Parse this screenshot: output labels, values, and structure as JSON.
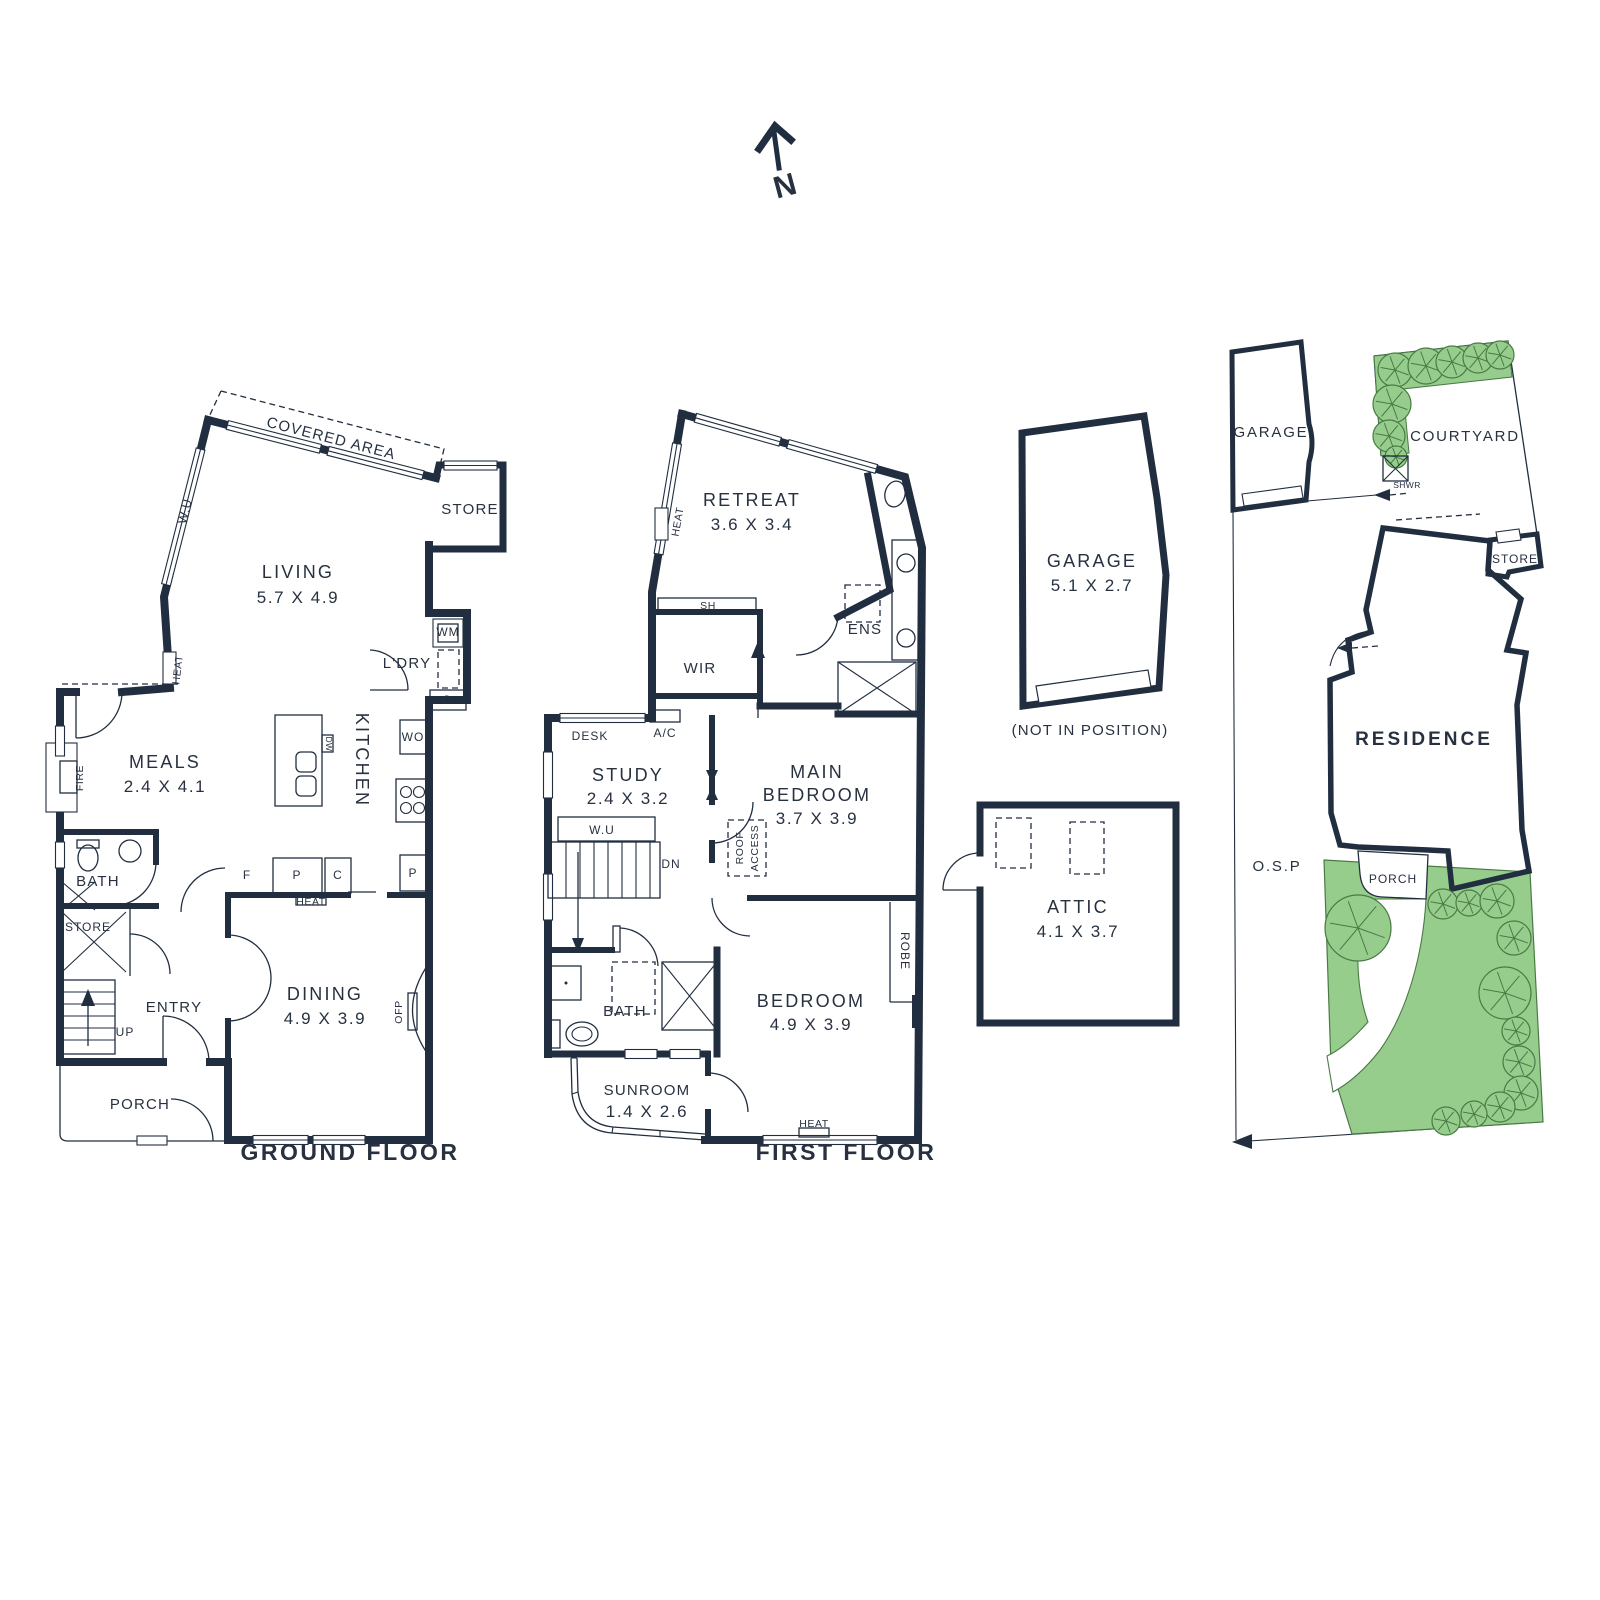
{
  "palette": {
    "wall": "#212e40",
    "text": "#273140",
    "green": "#96cd8d",
    "green_line": "#4a7a44"
  },
  "north": {
    "label": "N"
  },
  "ground": {
    "title": "GROUND FLOOR",
    "covered_area": "COVERED AREA",
    "wu": "W.U",
    "store_top": "STORE",
    "living": "LIVING",
    "living_dims": "5.7 X 4.9",
    "wm": "WM",
    "ldry": "L'DRY",
    "c_ldry": "C",
    "heat_left": "HEAT",
    "fire": "FIRE",
    "meals": "MEALS",
    "meals_dims": "2.4 X 4.1",
    "kitchen": "KITCHEN",
    "dw": "DW",
    "wo": "WO",
    "bath": "BATH",
    "store_stairs": "STORE",
    "f": "F",
    "p1": "P",
    "c2": "C",
    "heat_mid": "HEAT",
    "p2": "P",
    "entry": "ENTRY",
    "up": "UP",
    "dining": "DINING",
    "dining_dims": "4.9 X 3.9",
    "ofp": "OFP",
    "porch": "PORCH"
  },
  "first": {
    "title": "FIRST FLOOR",
    "retreat": "RETREAT",
    "retreat_dims": "3.6 X 3.4",
    "heat_left": "HEAT",
    "sh": "SH",
    "wir": "WIR",
    "ens": "ENS",
    "desk": "DESK",
    "ac": "A/C",
    "study": "STUDY",
    "study_dims": "2.4 X 3.2",
    "wu": "W.U",
    "dn": "DN",
    "roof_access_1": "ROOF",
    "roof_access_2": "ACCESS",
    "main_bedroom_1": "MAIN",
    "main_bedroom_2": "BEDROOM",
    "main_bedroom_dims": "3.7 X 3.9",
    "robe": "ROBE",
    "bath": "BATH",
    "bedroom": "BEDROOM",
    "bedroom_dims": "4.9 X 3.9",
    "sunroom": "SUNROOM",
    "sunroom_dims": "1.4 X 2.6",
    "heat_bottom": "HEAT"
  },
  "garage_plan": {
    "name": "GARAGE",
    "dims": "5.1 X 2.7",
    "note": "(NOT IN POSITION)"
  },
  "attic_plan": {
    "name": "ATTIC",
    "dims": "4.1 X 3.7"
  },
  "site": {
    "garage": "GARAGE",
    "courtyard": "COURTYARD",
    "shwr": "SHWR",
    "store": "STORE",
    "residence": "RESIDENCE",
    "osp": "O.S.P",
    "porch": "PORCH"
  }
}
